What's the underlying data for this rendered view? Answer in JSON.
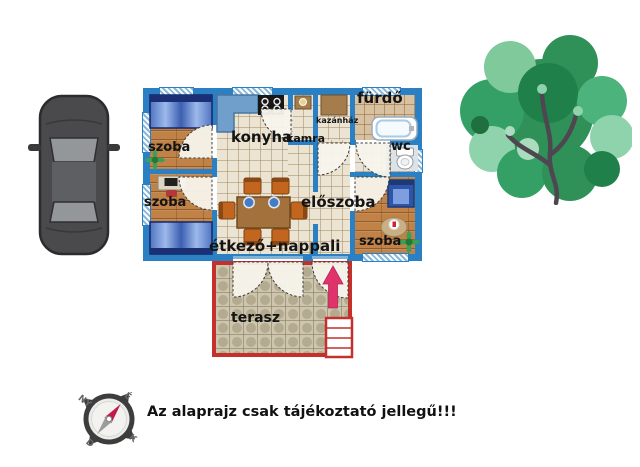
{
  "floorplan": {
    "rooms": {
      "bedroom_top_left": "szoba",
      "bedroom_bottom_left": "szoba",
      "bedroom_right": "szoba",
      "kitchen": "konyha",
      "pantry": "kamra",
      "boiler_room": "kazánház",
      "bathroom": "fürdő",
      "wc": "wc",
      "hallway": "előszoba",
      "dining_living": "étkező+nappali",
      "terrace": "terasz"
    },
    "colors": {
      "wall": "#2a80c2",
      "terrace_border": "#c4302b",
      "entrance_arrow": "#e0336b",
      "wood_floor": "#c08247",
      "tile_floor": "#ece4d2"
    }
  },
  "compass": {
    "north_label": "É",
    "west_label": "NY",
    "south_label": "D",
    "east_label": "K"
  },
  "disclaimer": "Az alaprajz csak tájékoztató jellegű!!!"
}
